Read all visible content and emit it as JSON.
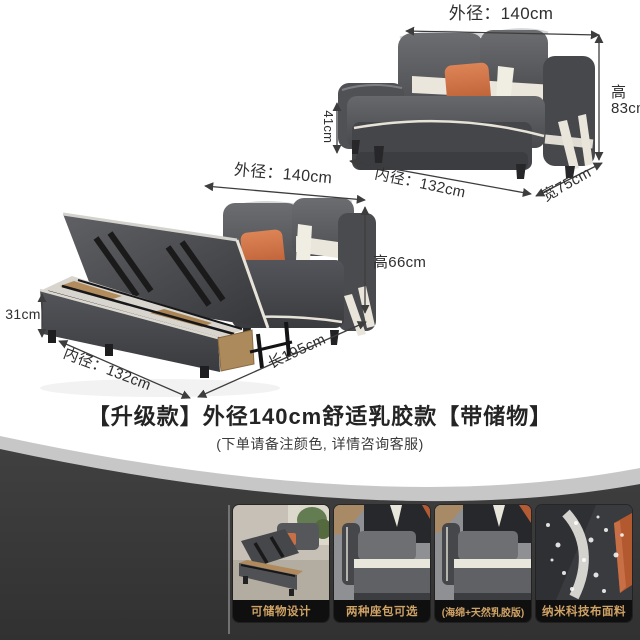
{
  "colors": {
    "accent_gold": "#cfa265",
    "band_dark": "#3a3a3a",
    "sofa_gray": "#56575b",
    "pillow_orange": "#c96f45",
    "trim_cream": "#e9e5da",
    "label_ink": "#2f2f2f"
  },
  "top_sofa": {
    "outer_width": "外径：140cm",
    "height_cn": "高",
    "height_value": "83cm",
    "seat_height": "41cm",
    "inner_width": "内径：132cm",
    "depth": "宽75cm"
  },
  "open_sofa": {
    "outer_width": "外径：140cm",
    "box_height": "31cm",
    "height": "高66cm",
    "inner_width": "内径：132cm",
    "bed_length": "长195cm"
  },
  "banner": {
    "title": "【升级款】外径140cm舒适乳胶款【带储物】",
    "subtitle": "(下单请备注颜色, 详情咨询客服)"
  },
  "features": [
    {
      "label": "可储物设计"
    },
    {
      "label": "两种座包可选"
    },
    {
      "label": "(海绵+天然乳胶版)"
    },
    {
      "label": "纳米科技布面料"
    }
  ]
}
